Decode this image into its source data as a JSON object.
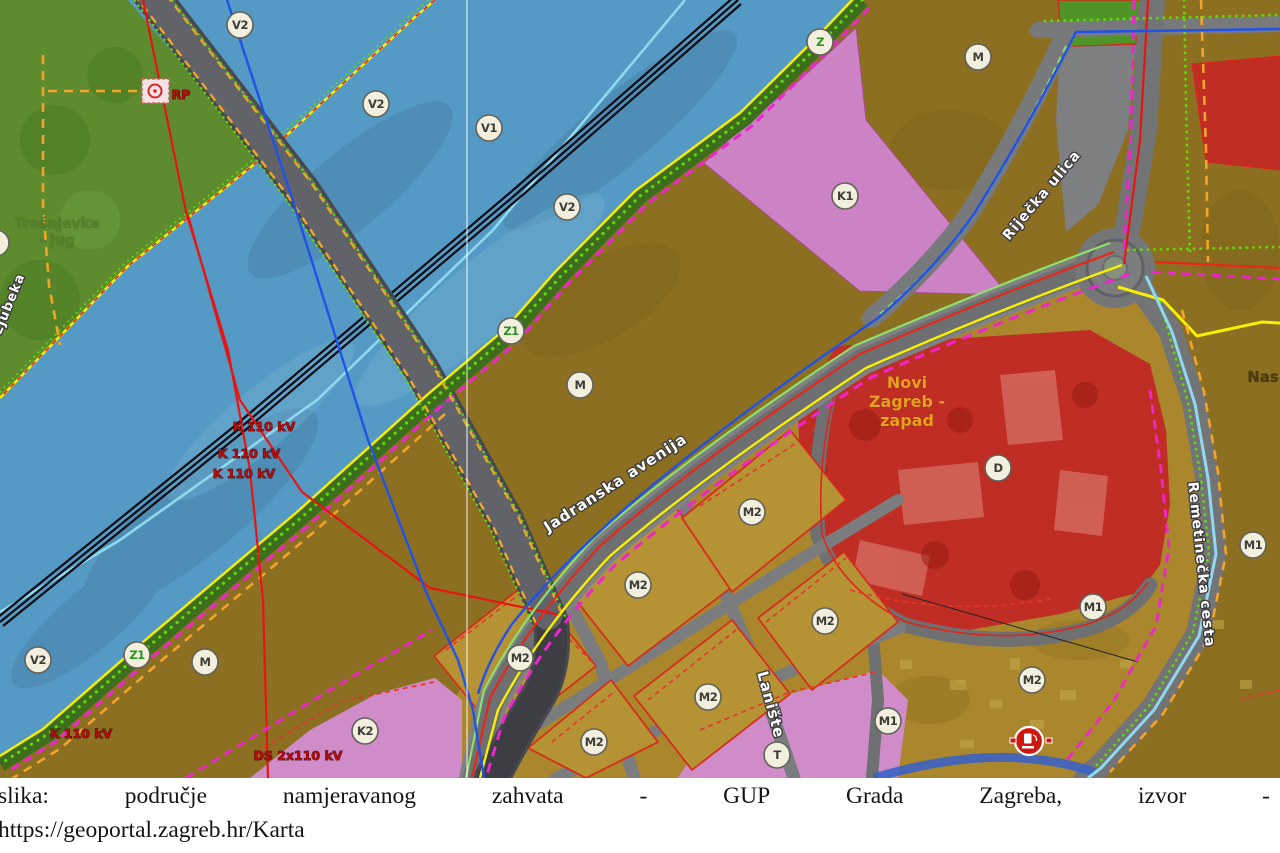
{
  "map": {
    "zone_badges": [
      {
        "text": "V2",
        "x": 240,
        "y": 25,
        "style": "dark"
      },
      {
        "text": "V2",
        "x": 376,
        "y": 104,
        "style": "dark"
      },
      {
        "text": "V1",
        "x": 489,
        "y": 128,
        "style": "dark"
      },
      {
        "text": "V2",
        "x": 567,
        "y": 207,
        "style": "dark"
      },
      {
        "text": "Z",
        "x": 820,
        "y": 42,
        "style": "green"
      },
      {
        "text": "M",
        "x": 978,
        "y": 57,
        "style": "dark"
      },
      {
        "text": "K1",
        "x": 845,
        "y": 196,
        "style": "dark"
      },
      {
        "text": "Z1",
        "x": 511,
        "y": 331,
        "style": "green"
      },
      {
        "text": "M",
        "x": 580,
        "y": 385,
        "style": "dark"
      },
      {
        "text": "D",
        "x": 998,
        "y": 468,
        "style": "dark"
      },
      {
        "text": "M2",
        "x": 752,
        "y": 512,
        "style": "dark"
      },
      {
        "text": "M1",
        "x": 1253,
        "y": 545,
        "style": "dark"
      },
      {
        "text": "M2",
        "x": 638,
        "y": 585,
        "style": "dark"
      },
      {
        "text": "M1",
        "x": 1093,
        "y": 607,
        "style": "dark"
      },
      {
        "text": "M2",
        "x": 825,
        "y": 621,
        "style": "dark"
      },
      {
        "text": "Z1",
        "x": 137,
        "y": 655,
        "style": "green"
      },
      {
        "text": "M2",
        "x": 520,
        "y": 658,
        "style": "dark"
      },
      {
        "text": "V2",
        "x": 38,
        "y": 660,
        "style": "dark"
      },
      {
        "text": "M",
        "x": 205,
        "y": 662,
        "style": "dark"
      },
      {
        "text": "M2",
        "x": 1032,
        "y": 680,
        "style": "dark"
      },
      {
        "text": "M2",
        "x": 708,
        "y": 697,
        "style": "dark"
      },
      {
        "text": "M1",
        "x": 888,
        "y": 721,
        "style": "dark"
      },
      {
        "text": "K2",
        "x": 365,
        "y": 731,
        "style": "dark"
      },
      {
        "text": "M2",
        "x": 594,
        "y": 742,
        "style": "dark"
      },
      {
        "text": "T",
        "x": 777,
        "y": 755,
        "style": "dark"
      },
      {
        "text": "3",
        "x": -4,
        "y": 243,
        "style": "dark"
      }
    ],
    "street_labels": [
      {
        "text": "Jadranska avenija",
        "x": 618,
        "y": 487,
        "rotate": -33,
        "size": 15
      },
      {
        "text": "Lanište",
        "x": 766,
        "y": 706,
        "rotate": 75,
        "size": 15
      },
      {
        "text": "Riječka ulica",
        "x": 1045,
        "y": 198,
        "rotate": -50,
        "size": 14
      },
      {
        "text": "Remetinečka cesta",
        "x": 1197,
        "y": 565,
        "rotate": 84,
        "size": 14
      },
      {
        "text": "Matije Ljubeka",
        "x": 2,
        "y": 332,
        "rotate": -68,
        "size": 13
      }
    ],
    "district_labels": [
      {
        "lines": [
          "Trešnjevka",
          "- jug"
        ],
        "x": 57,
        "y": 228,
        "color": "#55832c",
        "size": 14
      },
      {
        "lines": [
          "Novi",
          "Zagreb -",
          "zapad"
        ],
        "x": 907,
        "y": 388,
        "color": "#e8a020",
        "size": 16
      },
      {
        "lines": [
          "Nas"
        ],
        "x": 1263,
        "y": 382,
        "color": "#4e3a10",
        "size": 15
      }
    ],
    "infra_labels": [
      {
        "text": "K 110 kV",
        "x": 264,
        "y": 431
      },
      {
        "text": "K 110 kV",
        "x": 249,
        "y": 458
      },
      {
        "text": "K 110 kV",
        "x": 244,
        "y": 478
      },
      {
        "text": "K 110 kV",
        "x": 81,
        "y": 738
      },
      {
        "text": "DS 2x110 kV",
        "x": 298,
        "y": 760
      },
      {
        "text": "RP",
        "x": 181,
        "y": 99
      }
    ],
    "icons": [
      {
        "name": "rp-substation-icon",
        "x": 156,
        "y": 91
      },
      {
        "name": "petrol-station-icon",
        "x": 1029,
        "y": 741
      }
    ],
    "colors": {
      "water": "#559ac4",
      "park_green": "#5d8b2e",
      "mixed_olive": "#8c6f21",
      "mixed_gold": "#b59233",
      "commercial_pink": "#cb83c6",
      "public_red": "#bf2d24",
      "road_grey": "#747678",
      "bridge_grey": "#3c3e44",
      "line_yellow": "#f8f000",
      "line_green_dot": "#5fdc04",
      "line_orange": "#f2a52a",
      "line_magenta": "#ef25cf",
      "line_blue": "#1f52e8",
      "line_cyan": "#8fd9f0",
      "line_red": "#e51613",
      "zone_border_red": "#d8291b"
    }
  },
  "caption": {
    "line1": "slika: područje namjeravanog zahvata - GUP Grada Zagreba, izvor -",
    "line1_words": [
      "slika:",
      "područje",
      "namjeravanog",
      "zahvata",
      "-",
      "GUP",
      "Grada",
      "Zagreba,",
      "izvor",
      "-"
    ],
    "line2": "https://geoportal.zagreb.hr/Karta"
  }
}
